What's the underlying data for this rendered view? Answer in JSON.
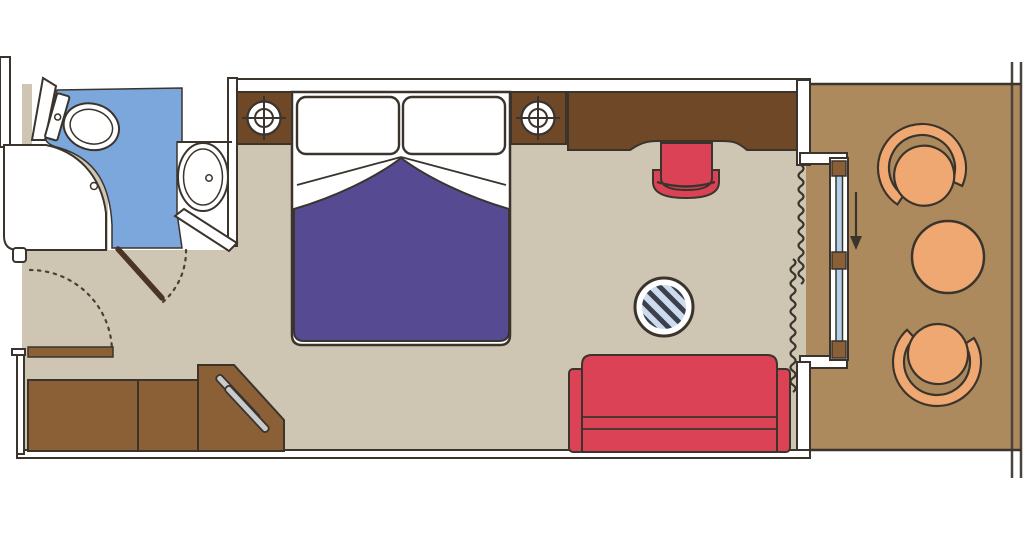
{
  "diagram": {
    "type": "cruise-cabin-floor-plan",
    "rooms": [
      "bathroom",
      "cabin",
      "balcony"
    ],
    "furniture": [
      "toilet",
      "washbasin",
      "shower",
      "double-bed",
      "pillows",
      "duvet",
      "nightstand-left",
      "nightstand-right",
      "reading-light-symbols",
      "wardrobe-units",
      "corner-wardrobe-with-hanging-rails",
      "entry-door",
      "bathroom-door",
      "desk",
      "desk-chair",
      "round-coffee-table",
      "sofa",
      "sliding-glass-door",
      "curtain",
      "balcony-armchairs",
      "balcony-table"
    ]
  },
  "colors": {
    "background": "#ffffff",
    "outline": "#3a342c",
    "wall_fill": "#ffffff",
    "room_floor": "#cec5b2",
    "balcony_floor": "#ac8a5e",
    "bathroom_floor": "#7ca7dc",
    "duvet_purple": "#564a92",
    "upholstery_red": "#dc4255",
    "wood_dark": "#6f4827",
    "wood_medium": "#8c6036",
    "door_leaf": "#4a3524",
    "balcony_furniture_orange": "#f0a873",
    "glass_blue": "#b3cfe9",
    "table_top_blue": "#ccdcee",
    "table_stripe": "#3b414c",
    "hanging_rod_gray": "#c9cacb"
  }
}
